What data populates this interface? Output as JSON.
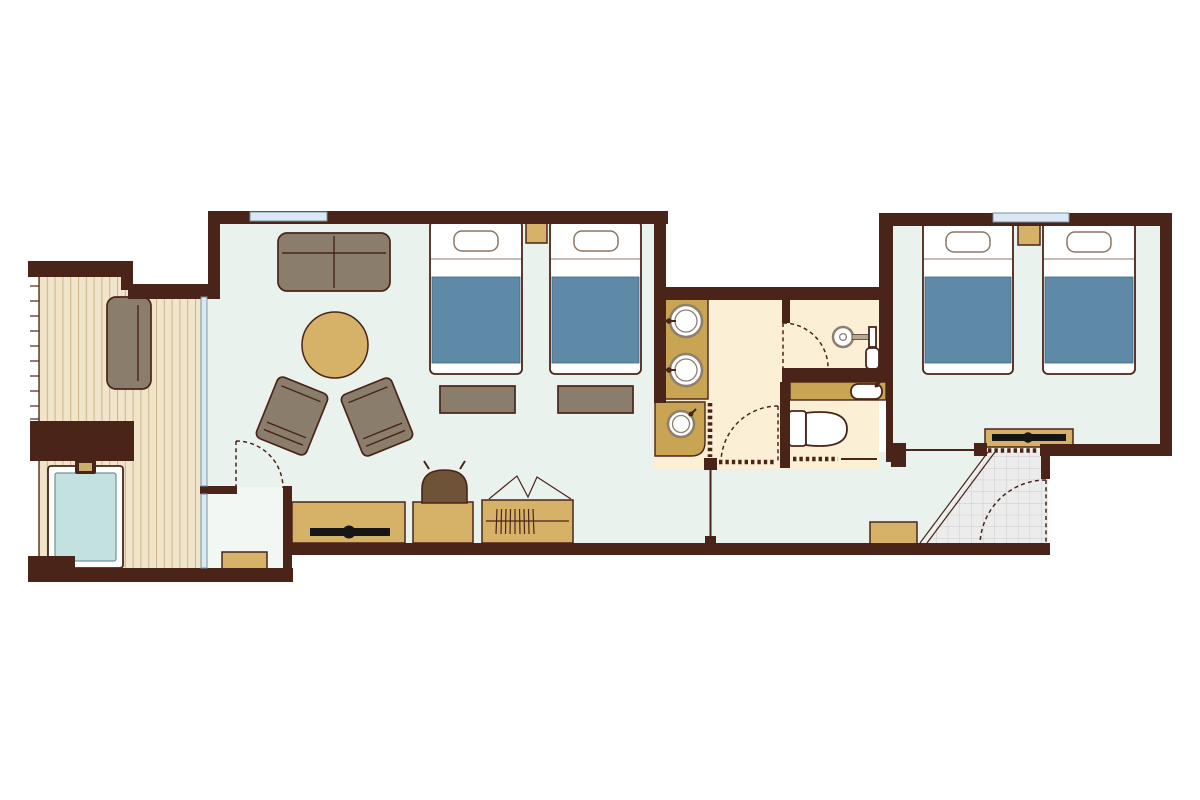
{
  "title": "hotel-suite-floor-plan",
  "colors": {
    "wall": "#4a2418",
    "floor_main": "#eaf2ee",
    "floor_nook": "#f3f7f4",
    "floor_bath": "#fbf0d6",
    "deck": "#f0e4ca",
    "deck_line": "#cdb488",
    "tan": "#d5b267",
    "counter": "#c9a452",
    "gray_furn": "#8b7d6b",
    "blanket": "#5e8aa8",
    "water": "#c3e1de",
    "window": "#d9e8f4",
    "tile": "#ececec",
    "tile_line": "#cbcbcb",
    "chair_brown": "#6e5338",
    "tv_black": "#161616",
    "pillow_line": "#8a7765",
    "sink_ring": "#8d7f6e"
  },
  "rooms": [
    {
      "id": "deck-terrace",
      "kind": "outdoor deck with hot tub"
    },
    {
      "id": "living-area",
      "kind": "living / lounge"
    },
    {
      "id": "bedroom-1",
      "kind": "twin bedroom open to living"
    },
    {
      "id": "closet-nook",
      "kind": "small nook with bench"
    },
    {
      "id": "corridor",
      "kind": "hallway"
    },
    {
      "id": "vanity-area",
      "kind": "double-sink vanity"
    },
    {
      "id": "dressing-area",
      "kind": "dressing / powder space"
    },
    {
      "id": "shower-room",
      "kind": "shower room"
    },
    {
      "id": "toilet-room",
      "kind": "toilet with hand basin"
    },
    {
      "id": "bedroom-2",
      "kind": "twin bedroom"
    },
    {
      "id": "entry-genkan",
      "kind": "tiled entrance"
    }
  ],
  "furniture": [
    "outdoor-sofa",
    "privacy-wall",
    "hot-tub",
    "living-sofa",
    "round-table",
    "armchair-left",
    "armchair-right",
    "twin-bed x4",
    "nightstand x2",
    "bed-bench x2",
    "tv-console x2",
    "desk",
    "desk-chair",
    "wardrobe",
    "luggage-rack",
    "nook-bench",
    "entry-bench",
    "vanity-sink x2",
    "alcove-sink",
    "hand-basin",
    "toilet",
    "shower-head",
    "shower-bench"
  ]
}
